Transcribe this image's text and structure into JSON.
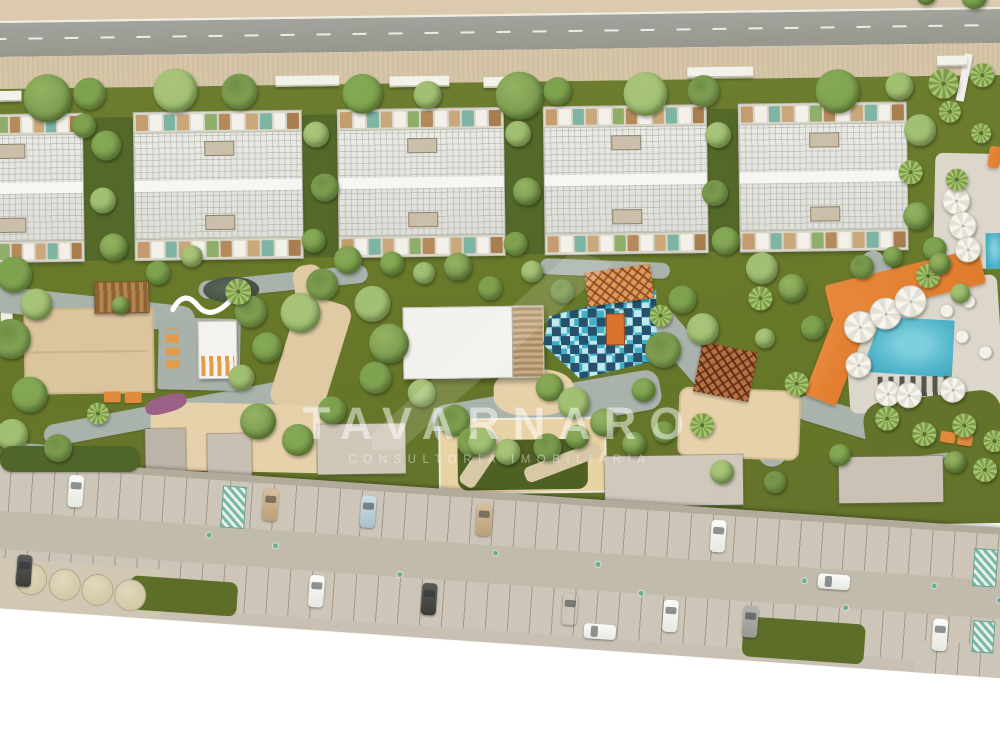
{
  "watermark": {
    "title": "TAVARNARO",
    "subtitle": "CONSULTORIA IMOBILIÁRIA"
  },
  "palette": {
    "road": "#9c9c96",
    "sidewalk": "#d6c5a7",
    "lawn": "#6d7d2f",
    "roof": "#e6e6e2",
    "sand": "#e7d1ab",
    "path": "#a9b2ab",
    "pool": "#4fb3c9",
    "orange_deck": "#e8883a",
    "playground_teal": "#3fb0c8",
    "garage": "#c8c1b3",
    "hatch_teal": "#79b7a6"
  },
  "scene": {
    "roof_tiles": [
      "#c59c6d",
      "#f2f0e9",
      "#7db4a3",
      "#c9a87b",
      "#f2f0e9",
      "#8fae6a",
      "#b5895a",
      "#f2f0e9",
      "#c9a87b",
      "#7db4a3",
      "#f2f0e9",
      "#a97e4e"
    ],
    "buildings": [
      [
        -62,
        146
      ],
      [
        136,
        167
      ],
      [
        340,
        165
      ],
      [
        546,
        162
      ],
      [
        741,
        167
      ]
    ],
    "hedges": [
      [
        84,
        52
      ],
      [
        303,
        37
      ],
      [
        505,
        41
      ],
      [
        708,
        33
      ]
    ],
    "walls": [
      [
        0,
        84,
        24
      ],
      [
        278,
        73,
        64
      ],
      [
        392,
        75,
        60
      ],
      [
        486,
        77,
        34
      ],
      [
        690,
        70,
        66
      ],
      [
        940,
        62,
        30
      ]
    ],
    "blocks": [
      [
        143,
        424,
        40,
        46,
        "#bcb5a7"
      ],
      [
        205,
        430,
        44,
        42,
        "#c8c1b3"
      ],
      [
        315,
        422,
        88,
        50,
        "#cfc7b8"
      ],
      [
        602,
        458,
        138,
        50,
        "#d0c9bb"
      ],
      [
        836,
        462,
        104,
        46,
        "#cac3b5"
      ]
    ],
    "trees": [
      [
        50,
        92,
        24
      ],
      [
        92,
        88,
        16
      ],
      [
        178,
        86,
        22
      ],
      [
        242,
        88,
        18
      ],
      [
        365,
        92,
        20
      ],
      [
        430,
        94,
        14
      ],
      [
        522,
        96,
        24
      ],
      [
        560,
        92,
        14
      ],
      [
        648,
        96,
        22
      ],
      [
        706,
        94,
        16
      ],
      [
        840,
        96,
        22
      ],
      [
        902,
        92,
        14
      ],
      [
        930,
        1,
        10
      ],
      [
        978,
        3,
        13
      ],
      [
        946,
        90,
        15,
        "p"
      ],
      [
        985,
        82,
        12,
        "p"
      ],
      [
        108,
        140,
        15
      ],
      [
        104,
        195,
        13
      ],
      [
        114,
        242,
        14
      ],
      [
        86,
        120,
        12
      ],
      [
        318,
        132,
        13
      ],
      [
        326,
        185,
        14
      ],
      [
        314,
        238,
        12
      ],
      [
        520,
        134,
        13
      ],
      [
        528,
        192,
        14
      ],
      [
        516,
        244,
        12
      ],
      [
        720,
        138,
        13
      ],
      [
        716,
        196,
        13
      ],
      [
        726,
        244,
        14
      ],
      [
        922,
        136,
        16
      ],
      [
        918,
        222,
        14
      ],
      [
        935,
        255,
        12
      ],
      [
        912,
        178,
        12,
        "p"
      ],
      [
        952,
        118,
        11,
        "p"
      ],
      [
        983,
        140,
        10,
        "p"
      ],
      [
        958,
        186,
        11,
        "p"
      ],
      [
        928,
        282,
        12,
        "p"
      ],
      [
        14,
        268,
        18
      ],
      [
        36,
        298,
        16
      ],
      [
        10,
        332,
        20
      ],
      [
        28,
        388,
        18
      ],
      [
        10,
        428,
        16
      ],
      [
        120,
        300,
        9
      ],
      [
        158,
        268,
        12
      ],
      [
        192,
        252,
        11
      ],
      [
        250,
        308,
        16
      ],
      [
        266,
        344,
        15
      ],
      [
        240,
        374,
        13
      ],
      [
        256,
        418,
        18
      ],
      [
        330,
        408,
        14
      ],
      [
        300,
        310,
        20
      ],
      [
        322,
        282,
        16
      ],
      [
        348,
        258,
        14
      ],
      [
        372,
        302,
        18
      ],
      [
        388,
        342,
        20
      ],
      [
        374,
        376,
        16
      ],
      [
        420,
        392,
        14
      ],
      [
        452,
        420,
        16
      ],
      [
        392,
        262,
        12
      ],
      [
        424,
        272,
        11
      ],
      [
        458,
        266,
        14
      ],
      [
        490,
        288,
        12
      ],
      [
        532,
        272,
        11
      ],
      [
        562,
        292,
        12
      ],
      [
        548,
        388,
        14
      ],
      [
        572,
        404,
        16
      ],
      [
        602,
        424,
        14
      ],
      [
        682,
        302,
        14
      ],
      [
        702,
        332,
        16
      ],
      [
        662,
        352,
        18
      ],
      [
        642,
        392,
        12
      ],
      [
        762,
        272,
        16
      ],
      [
        792,
        292,
        14
      ],
      [
        812,
        332,
        12
      ],
      [
        764,
        342,
        10
      ],
      [
        862,
        272,
        12
      ],
      [
        893,
        262,
        10
      ],
      [
        960,
        300,
        10
      ],
      [
        940,
        270,
        11
      ],
      [
        470,
        442,
        15
      ],
      [
        505,
        452,
        13
      ],
      [
        545,
        448,
        14
      ],
      [
        575,
        438,
        12
      ],
      [
        238,
        288,
        13,
        "p"
      ],
      [
        760,
        302,
        12,
        "p"
      ],
      [
        795,
        388,
        12,
        "p"
      ],
      [
        700,
        428,
        12,
        "p"
      ],
      [
        96,
        408,
        11,
        "p"
      ],
      [
        660,
        318,
        11,
        "p"
      ],
      [
        885,
        424,
        12,
        "p"
      ],
      [
        922,
        440,
        12,
        "p"
      ],
      [
        962,
        432,
        12,
        "p"
      ],
      [
        992,
        448,
        11,
        "p"
      ],
      [
        58,
        448,
        14,
        "b",
        2
      ],
      [
        298,
        440,
        16,
        "b",
        2
      ],
      [
        482,
        442,
        14,
        "b",
        2
      ],
      [
        634,
        444,
        12,
        "b",
        2
      ],
      [
        664,
        432,
        11,
        "b",
        2
      ],
      [
        722,
        472,
        12,
        "b",
        2
      ],
      [
        775,
        482,
        11,
        "b",
        2
      ],
      [
        840,
        455,
        11,
        "b",
        2
      ],
      [
        985,
        470,
        12,
        "p",
        2
      ],
      [
        955,
        462,
        11,
        "b",
        2
      ]
    ],
    "umbrellas": [
      [
        858,
        331,
        15
      ],
      [
        884,
        318,
        15
      ],
      [
        909,
        306,
        15
      ],
      [
        856,
        369,
        12
      ],
      [
        885,
        398,
        12
      ],
      [
        906,
        400,
        12
      ],
      [
        950,
        395,
        12
      ],
      [
        956,
        206,
        13
      ],
      [
        962,
        231,
        13
      ],
      [
        967,
        255,
        12
      ]
    ],
    "tables": [
      [
        945,
        316
      ],
      [
        967,
        307
      ],
      [
        960,
        342
      ],
      [
        983,
        358
      ]
    ],
    "cars": [
      [
        124,
        12,
        "white",
        "v"
      ],
      [
        319,
        12,
        "tan",
        "v"
      ],
      [
        417,
        12,
        "blue",
        "v"
      ],
      [
        533,
        12,
        "tan",
        "v"
      ],
      [
        768,
        12,
        "white",
        "v"
      ],
      [
        78,
        95,
        "dark",
        "v"
      ],
      [
        371,
        95,
        "white",
        "v"
      ],
      [
        484,
        95,
        "dark",
        "v"
      ],
      [
        625,
        95,
        "orange",
        "v"
      ],
      [
        726,
        95,
        "white",
        "v"
      ],
      [
        806,
        95,
        "grey",
        "v"
      ],
      [
        996,
        95,
        "white",
        "v"
      ],
      [
        878,
        58,
        "white",
        "h"
      ],
      [
        648,
        124,
        "white",
        "h"
      ]
    ],
    "markers": [
      [
        265,
        60
      ],
      [
        332,
        66
      ],
      [
        552,
        58
      ],
      [
        655,
        62
      ],
      [
        862,
        64
      ],
      [
        992,
        60
      ],
      [
        458,
        86
      ],
      [
        700,
        88
      ],
      [
        905,
        88
      ],
      [
        1058,
        70
      ]
    ],
    "planters": [
      [
        92,
        118
      ],
      [
        126,
        121
      ],
      [
        159,
        124
      ],
      [
        192,
        127
      ]
    ],
    "hatches": [
      [
        278,
        12,
        22,
        40
      ],
      [
        1032,
        22,
        22,
        36
      ],
      [
        1036,
        94,
        20,
        30
      ]
    ],
    "garage_lawns": [
      [
        192,
        108,
        108,
        34
      ],
      [
        807,
        106,
        122,
        40
      ]
    ]
  }
}
